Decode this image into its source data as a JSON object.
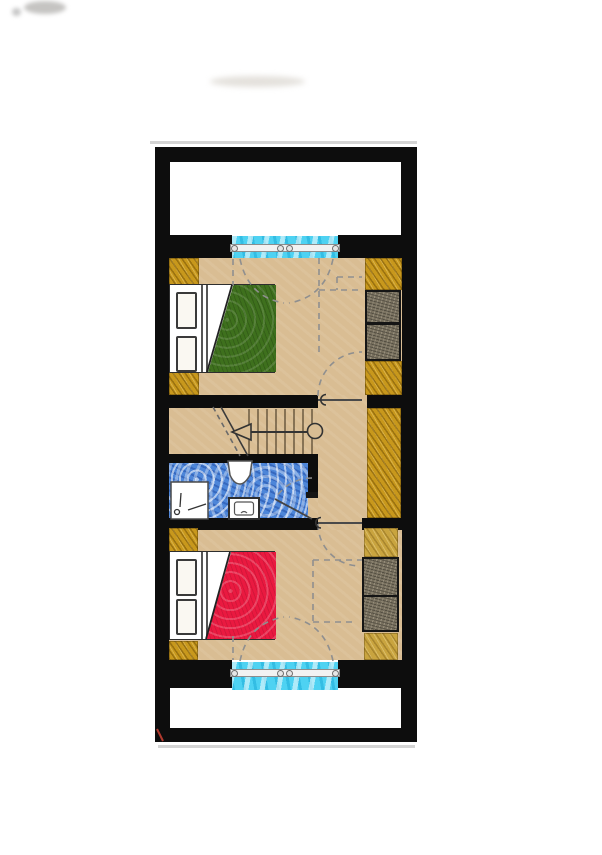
{
  "document_kind": "architectural-floor-plan",
  "floorplan": {
    "areas": [
      "top-balcony",
      "top-bedroom",
      "staircase",
      "hallway",
      "bathroom",
      "bottom-bedroom",
      "bottom-balcony"
    ],
    "top_bedroom_fixtures": [
      "double-bed-green-blanket",
      "two-pillows",
      "corner-wardrobes",
      "dresser",
      "french-door-window",
      "entry-door"
    ],
    "middle_fixtures": [
      "staircase-with-direction-arrow",
      "newel-post",
      "storage-closet",
      "shower",
      "wash-basin",
      "toilet",
      "bathroom-door"
    ],
    "bottom_bedroom_fixtures": [
      "double-bed-red-blanket",
      "two-pillows",
      "corner-wardrobes",
      "dresser",
      "french-door-window",
      "entry-door"
    ],
    "balconies": [
      "top-balcony-walls",
      "bottom-balcony-walls"
    ]
  },
  "colors": {
    "wall": "#0d0d0d",
    "floor_tan": "#d9bd93",
    "wood_gold": "#c8981c",
    "wood_light": "#c9a43f",
    "dresser_gray": "#7a7260",
    "blanket_green": "#3e701d",
    "blanket_red": "#ea1940",
    "window_cyan": "#4ed2f2",
    "bath_blue": "#4d86d9",
    "bed_white": "#ffffff",
    "ink": "#333333",
    "dash_gray": "#8f8f8f",
    "track_gray": "#f2f2f2",
    "faint_gray": "#c9c9c9",
    "red_mark": "#b03a2e"
  }
}
